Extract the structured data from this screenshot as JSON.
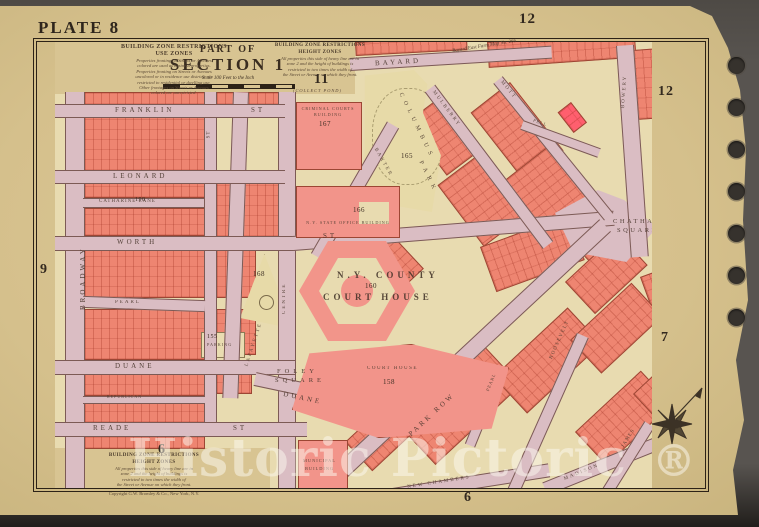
{
  "page": {
    "plate_label": "PLATE 8",
    "watermark_text": "Historic Pictoric",
    "watermark_symbol": "®"
  },
  "title_block": {
    "part_of": "PART OF",
    "section": "SECTION 1",
    "scale_note": "Scale 100 Feet to the Inch"
  },
  "margin_numbers": {
    "top_right_outer": "12",
    "top_right_inner": "12",
    "center_top": "11",
    "left": "9",
    "right": "7",
    "bottom_left": "6",
    "bottom_center": "6"
  },
  "notes": {
    "use_zones": {
      "heading1": "BUILDING ZONE RESTRICTIONS",
      "heading2": "USE ZONES",
      "body": [
        "Properties fronting on Streets or Avenues",
        "colored are used as business properties.",
        "Properties fronting on Streets or Avenues",
        "uncolored or in residence use districts are",
        "restricted to residential or dwelling use.",
        "Other frontages on Streets or Avenues",
        "colored are unrestricted."
      ]
    },
    "height_zones_top": {
      "heading1": "BUILDING ZONE RESTRICTIONS",
      "heading2": "HEIGHT ZONES",
      "body": [
        "All properties this side of heavy line are in",
        "zone 2 and the height of buildings is",
        "restricted to two times the width of",
        "the Street or Avenue on which they front."
      ]
    },
    "height_zones_bottom": {
      "heading1": "BUILDING ZONE RESTRICTIONS",
      "heading2": "HEIGHT ZONES",
      "body": [
        "All properties this side of heavy line are in",
        "zone 2 and the height of buildings is",
        "restricted to two times the width of",
        "the Street or Avenue on which they front."
      ],
      "copyright": "Copyright G.W. Bromley & Co., New York, N.Y."
    },
    "farm_note": "Bayard East Farm Map No. 266",
    "collect_pond": "(COLLECT POND)"
  },
  "streets": {
    "broadway": "BROADWAY",
    "elm": "ST",
    "lafayette": "LAFAYETTE",
    "centre": "CENTRE",
    "franklin": "FRANKLIN",
    "franklin_suffix": "ST",
    "leonard": "LEONARD",
    "catharine": "CATHARINE LANE",
    "worth": "WORTH",
    "worth_suffix": "ST",
    "pearl_west": "PEARL",
    "duane": "DUANE",
    "duane_east": "DUANE",
    "republican": "REPUBLICAN",
    "reade": "READE",
    "reade_suffix": "ST",
    "bayard": "BAYARD",
    "baxter": "BAXTER",
    "mulberry": "MULBERRY",
    "mott": "MOTT",
    "pell": "PELL",
    "bowery": "BOWERY",
    "park_row": "PARK ROW",
    "new_chambers": "NEW CHAMBERS",
    "madison": "MADISON",
    "madison_suffix": "ST.",
    "roosevelt": "ROOSEVELT",
    "james": "JAMES",
    "pearl_east": "PEARL"
  },
  "places": {
    "columbus_word1": "COLUMBUS",
    "columbus_word2": "PARK",
    "columbus_num": "165",
    "criminal_line1": "CRIMINAL COURTS",
    "criminal_line2": "BUILDING",
    "criminal_num": "167",
    "state_office": "N.Y. STATE OFFICE BUILDING",
    "state_office_num": "166",
    "county_line1": "N.Y. COUNTY",
    "county_line2": "COURT HOUSE",
    "county_num": "160",
    "foley_line1": "FOLEY",
    "foley_line2": "SQUARE",
    "court_house": "COURT HOUSE",
    "court_house_num": "158",
    "chatham_line1": "CHATHAM",
    "chatham_line2": "SQUARE",
    "municipal_line1": "MUNICIPAL",
    "municipal_line2": "BUILDING",
    "triangle_num": "168",
    "catharine_num": "190",
    "parking": "PARKING",
    "parking_num": "155"
  }
}
